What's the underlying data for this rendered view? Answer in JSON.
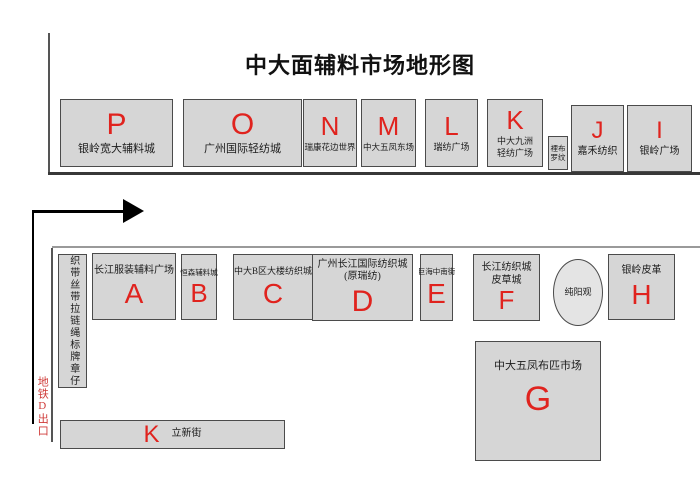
{
  "title": "中大面辅料市场地形图",
  "colors": {
    "box_fill": "#d6d6d6",
    "box_border": "#4b4b4b",
    "letter_red": "#e0231e",
    "metro_red": "#cf3a38"
  },
  "top_row": {
    "P": {
      "letter": "P",
      "label": "银岭宽大辅料城"
    },
    "O": {
      "letter": "O",
      "label": "广州国际轻纺城"
    },
    "N": {
      "letter": "N",
      "label": "瑞康花边世界"
    },
    "M": {
      "letter": "M",
      "label": "中大五凤东场"
    },
    "L": {
      "letter": "L",
      "label": "瑞纺广场"
    },
    "K": {
      "letter": "K",
      "label_line1": "中大九洲",
      "label_line2": "轻纺广场"
    },
    "lining": {
      "label_line1": "裡布",
      "label_line2": "罗纹"
    },
    "J": {
      "letter": "J",
      "label": "嘉禾纺织"
    },
    "I": {
      "letter": "I",
      "label": "银岭广场"
    }
  },
  "second_row": {
    "strip": {
      "label": "织带丝带拉链绳标牌章仔"
    },
    "A": {
      "letter": "A",
      "label": "长江服装辅料广场"
    },
    "B": {
      "letter": "B",
      "label": "恒森辅料城"
    },
    "C": {
      "letter": "C",
      "label": "中大B区大楼纺织城"
    },
    "D": {
      "letter": "D",
      "label_line1": "广州长江国际纺织城",
      "label_line2": "(原瑞纺)"
    },
    "E": {
      "letter": "E",
      "label": "巨海中南街"
    },
    "F": {
      "letter": "F",
      "label_line1": "长江纺织城",
      "label_line2": "皮草城"
    },
    "temple": {
      "label": "纯阳观"
    },
    "H": {
      "letter": "H",
      "label": "银岭皮革"
    }
  },
  "south": {
    "G": {
      "letter": "G",
      "label": "中大五凤布匹市场"
    },
    "street": {
      "letter": "K",
      "label": "立新街"
    },
    "metro_exit": {
      "label": "地铁D出口"
    }
  }
}
